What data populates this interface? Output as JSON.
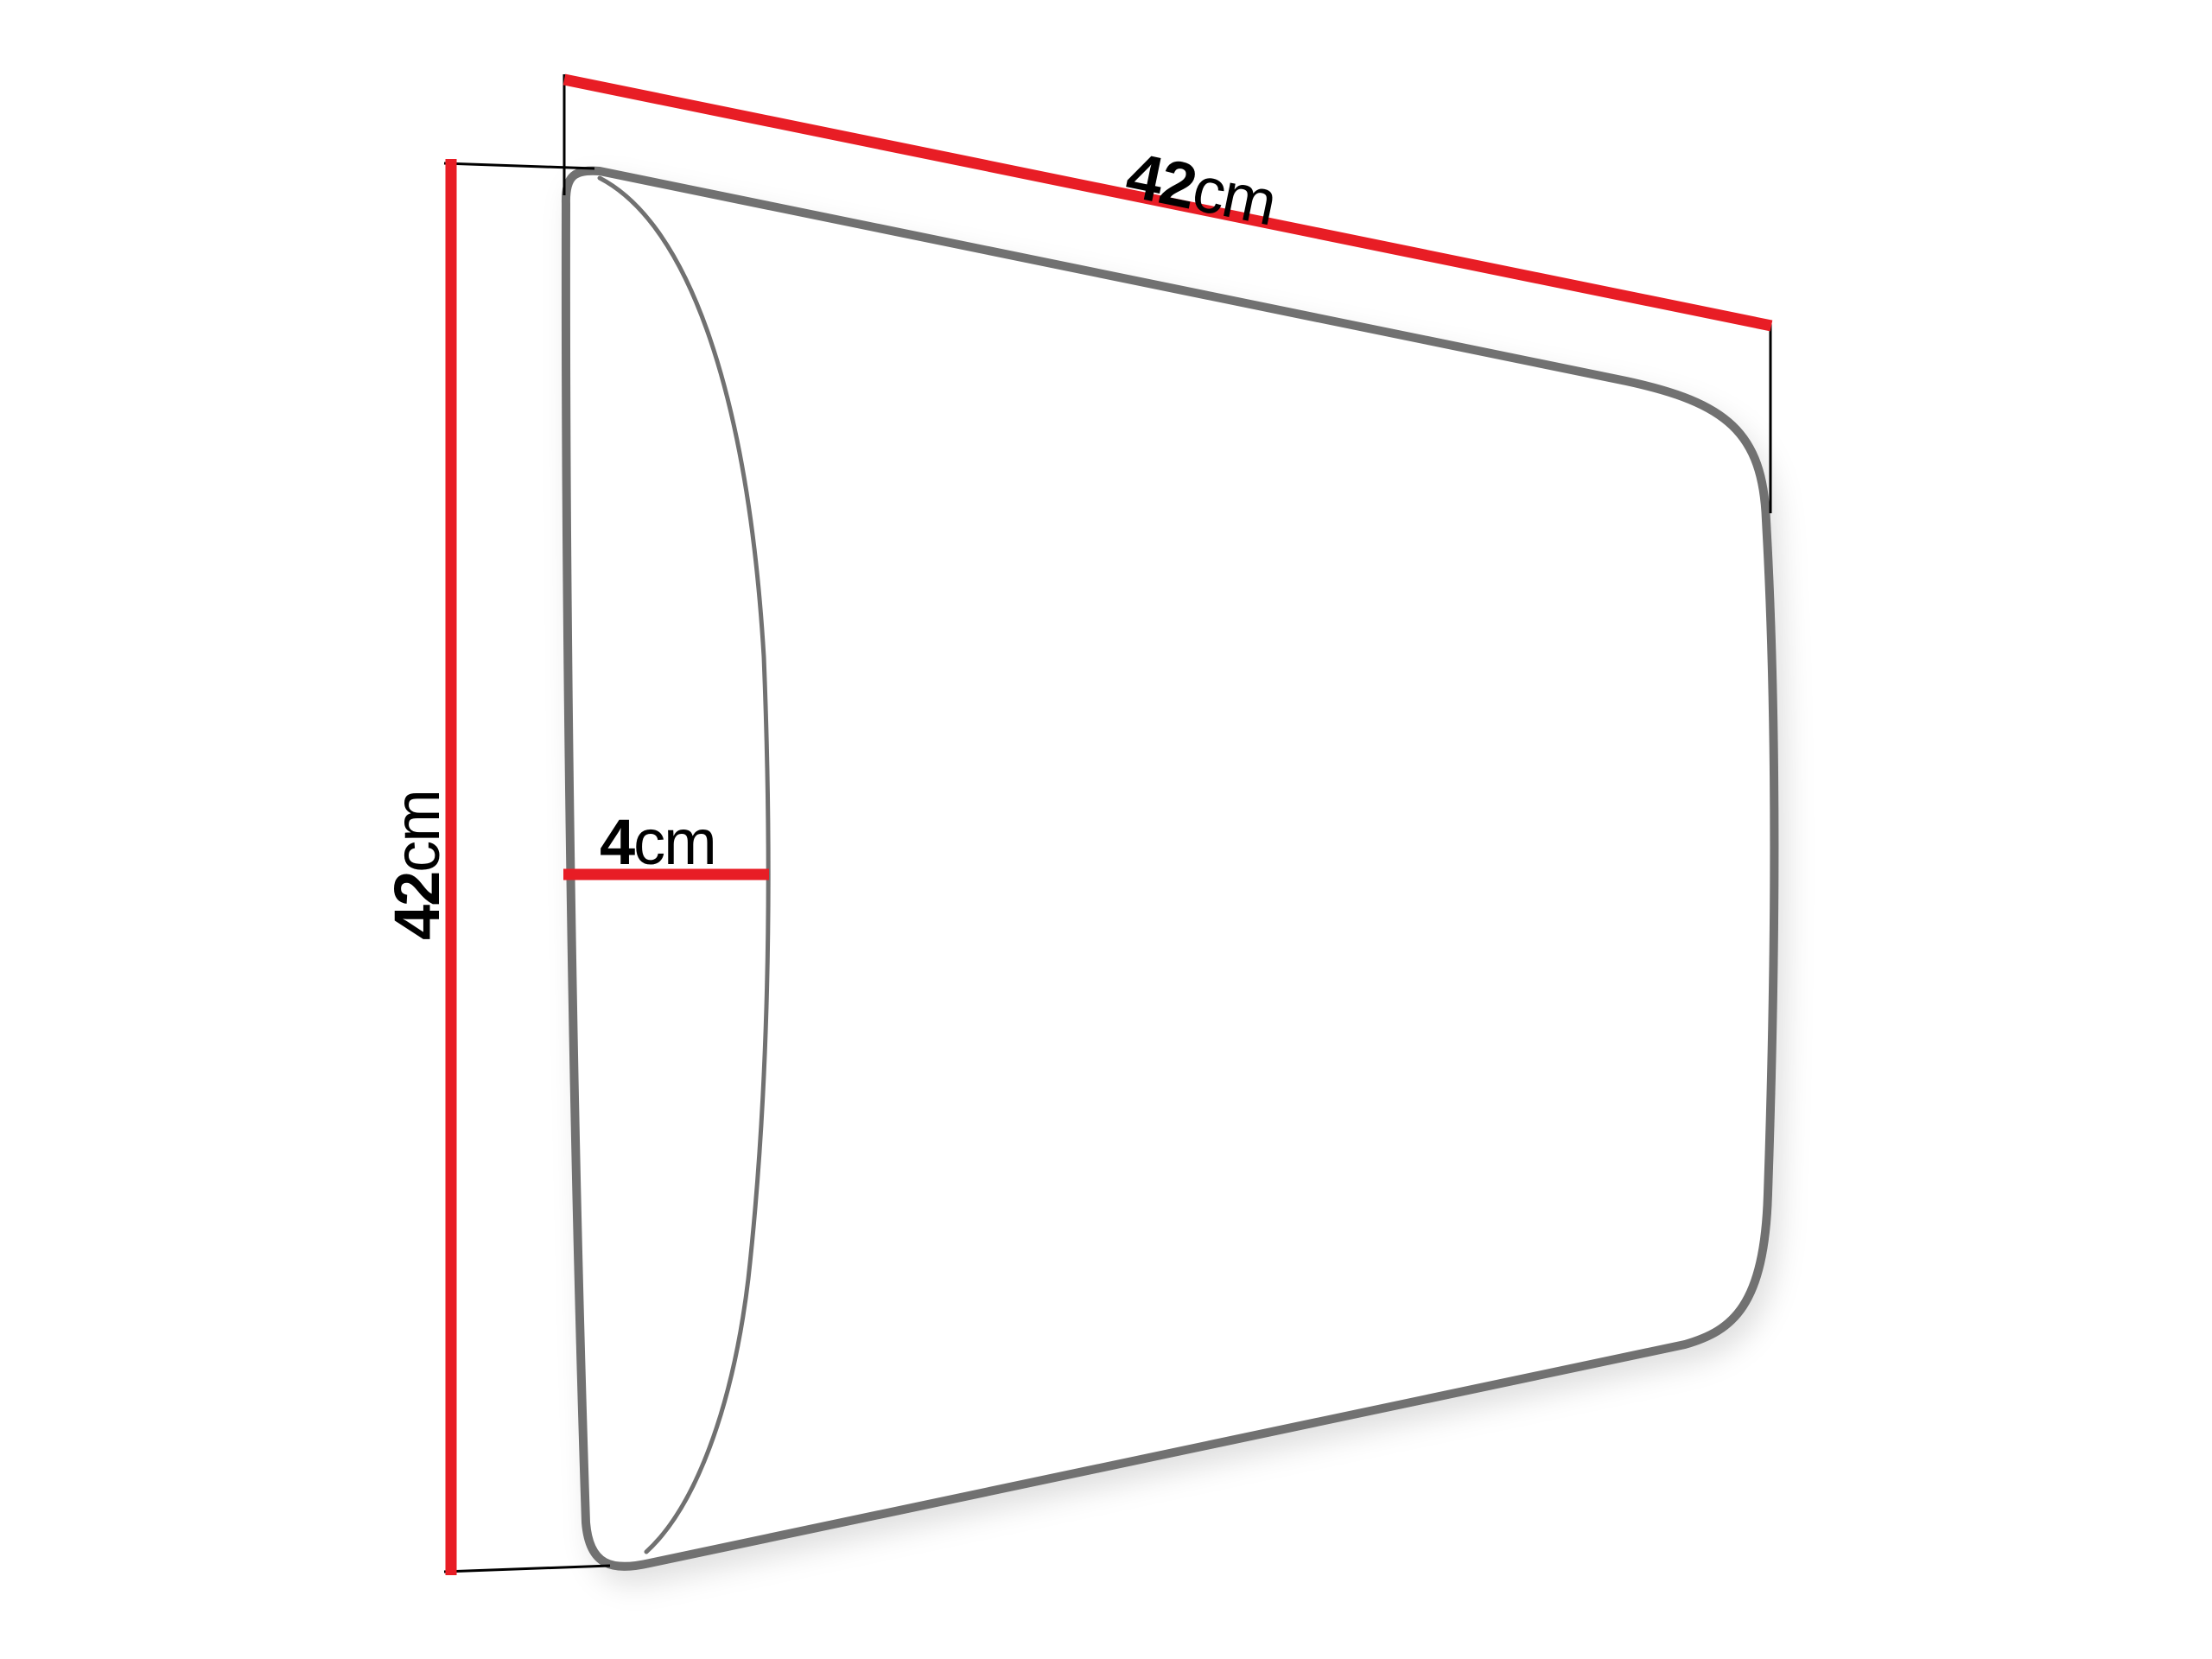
{
  "diagram": {
    "dimensions": {
      "width": {
        "value": "42",
        "unit": "cm"
      },
      "height": {
        "value": "42",
        "unit": "cm"
      },
      "depth": {
        "value": "4",
        "unit": "cm"
      }
    },
    "colors": {
      "dimension_line": "#e81d25",
      "panel_outline": "#717171",
      "extension_line": "#000000",
      "background": "#ffffff"
    }
  }
}
